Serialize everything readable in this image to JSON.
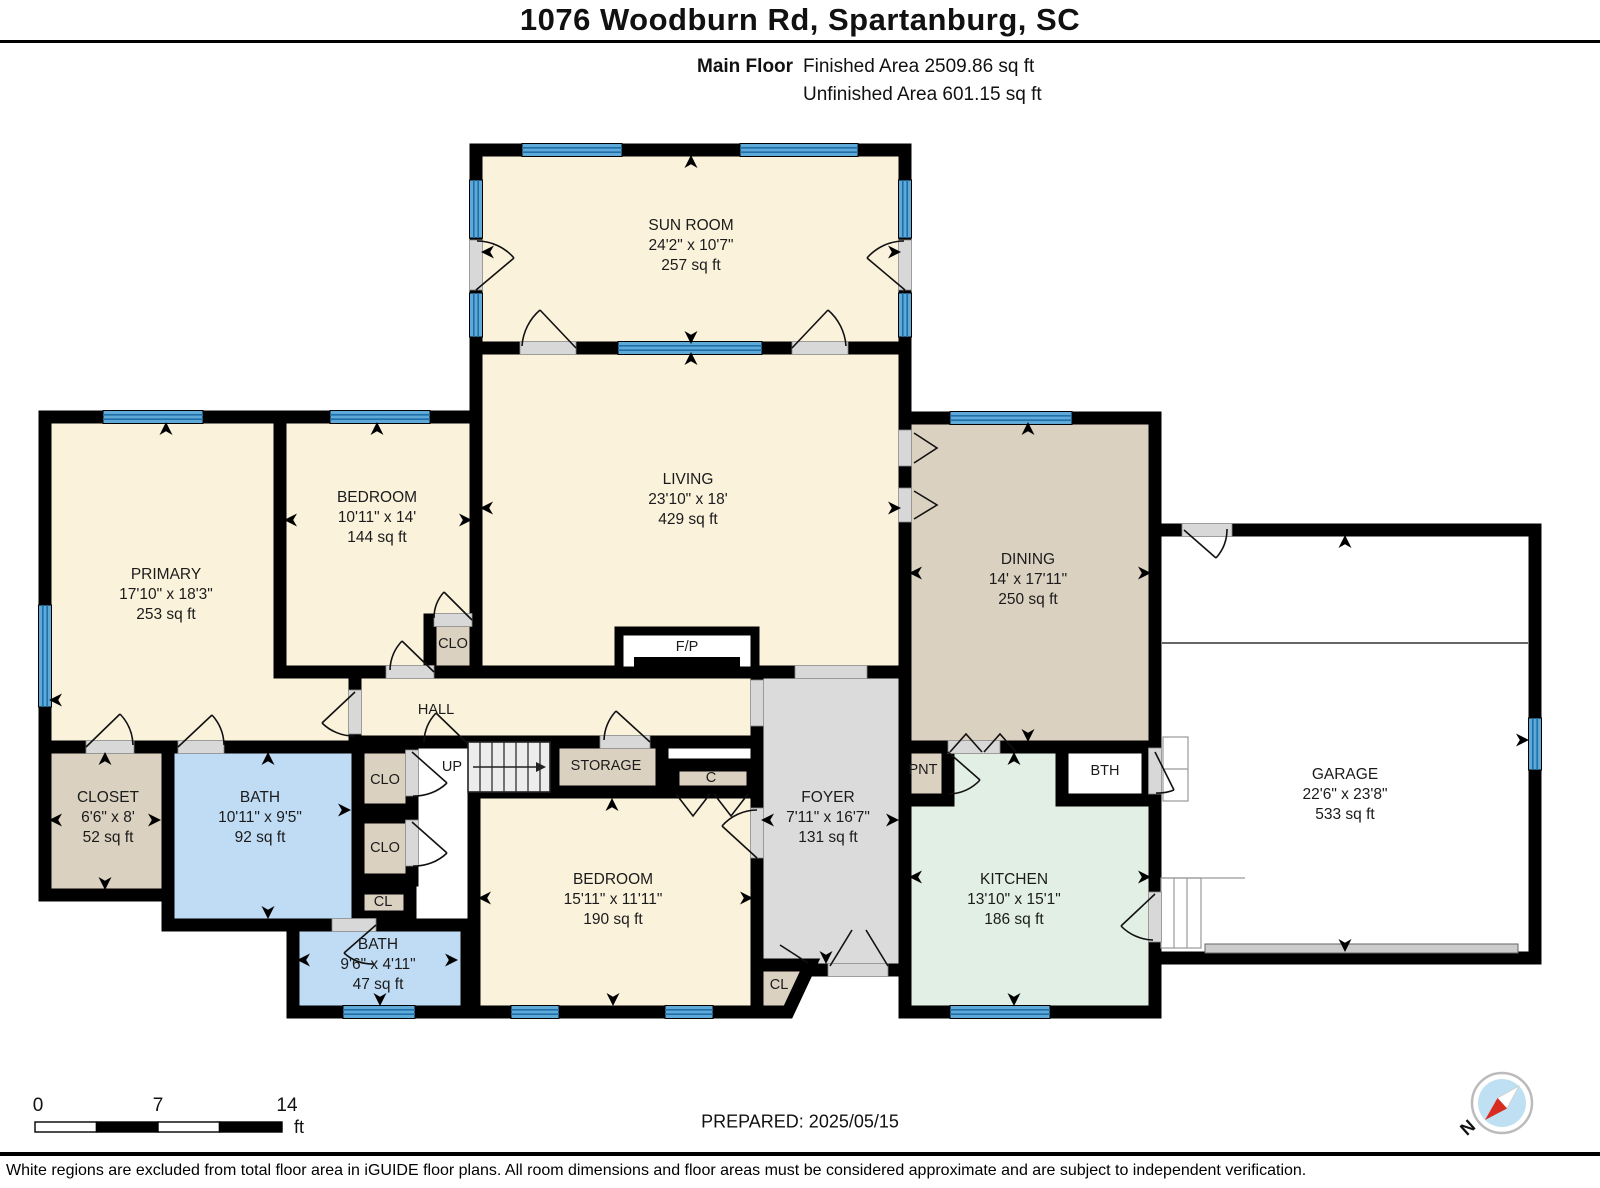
{
  "header": {
    "title": "1076 Woodburn Rd, Spartanburg, SC",
    "floor_label": "Main Floor",
    "finished_area": "Finished Area 2509.86 sq ft",
    "unfinished_area": "Unfinished Area 601.15 sq ft"
  },
  "rooms": {
    "sunroom": {
      "name": "SUN ROOM",
      "dims": "24'2\" x 10'7\"",
      "area": "257 sq ft"
    },
    "living": {
      "name": "LIVING",
      "dims": "23'10\" x 18'",
      "area": "429 sq ft"
    },
    "primary": {
      "name": "PRIMARY",
      "dims": "17'10\" x 18'3\"",
      "area": "253 sq ft"
    },
    "bedroom": {
      "name": "BEDROOM",
      "dims": "10'11\" x 14'",
      "area": "144 sq ft"
    },
    "dining": {
      "name": "DINING",
      "dims": "14' x 17'11\"",
      "area": "250 sq ft"
    },
    "garage": {
      "name": "GARAGE",
      "dims": "22'6\" x 23'8\"",
      "area": "533 sq ft"
    },
    "closet": {
      "name": "CLOSET",
      "dims": "6'6\" x 8'",
      "area": "52 sq ft"
    },
    "bath": {
      "name": "BATH",
      "dims": "10'11\" x 9'5\"",
      "area": "92 sq ft"
    },
    "bath2": {
      "name": "BATH",
      "dims": "9'6\" x 4'11\"",
      "area": "47 sq ft"
    },
    "bedroom2": {
      "name": "BEDROOM",
      "dims": "15'11\" x 11'11\"",
      "area": "190 sq ft"
    },
    "foyer": {
      "name": "FOYER",
      "dims": "7'11\" x 16'7\"",
      "area": "131 sq ft"
    },
    "kitchen": {
      "name": "KITCHEN",
      "dims": "13'10\" x 15'1\"",
      "area": "186 sq ft"
    }
  },
  "labels": {
    "hall": "HALL",
    "up": "UP",
    "storage": "STORAGE",
    "c": "C",
    "fp": "F/P",
    "clo_bedroom": "CLO",
    "clo1": "CLO",
    "clo2": "CLO",
    "cl_hall": "CL",
    "cl_foyer": "CL",
    "pnt": "PNT",
    "bth": "BTH"
  },
  "scale_bar": {
    "tick0": "0",
    "tick1": "7",
    "tick2": "14",
    "unit": "ft"
  },
  "prepared": "PREPARED: 2025/05/15",
  "compass": {
    "north": "N"
  },
  "footer": "White regions are excluded from total floor area in iGUIDE floor plans. All room dimensions and floor areas must be considered approximate and are subject to independent verification.",
  "colors": {
    "finished_room": "#FAF2DB",
    "closet_tan": "#DBD1C1",
    "bath_blue": "#BFDCF4",
    "kitchen_mint": "#E2EFE5",
    "foyer_gray": "#DBDBDB",
    "unfinished_white": "#FFFFFF",
    "wall": "#000000",
    "window_blue": "#5FA9D9"
  }
}
